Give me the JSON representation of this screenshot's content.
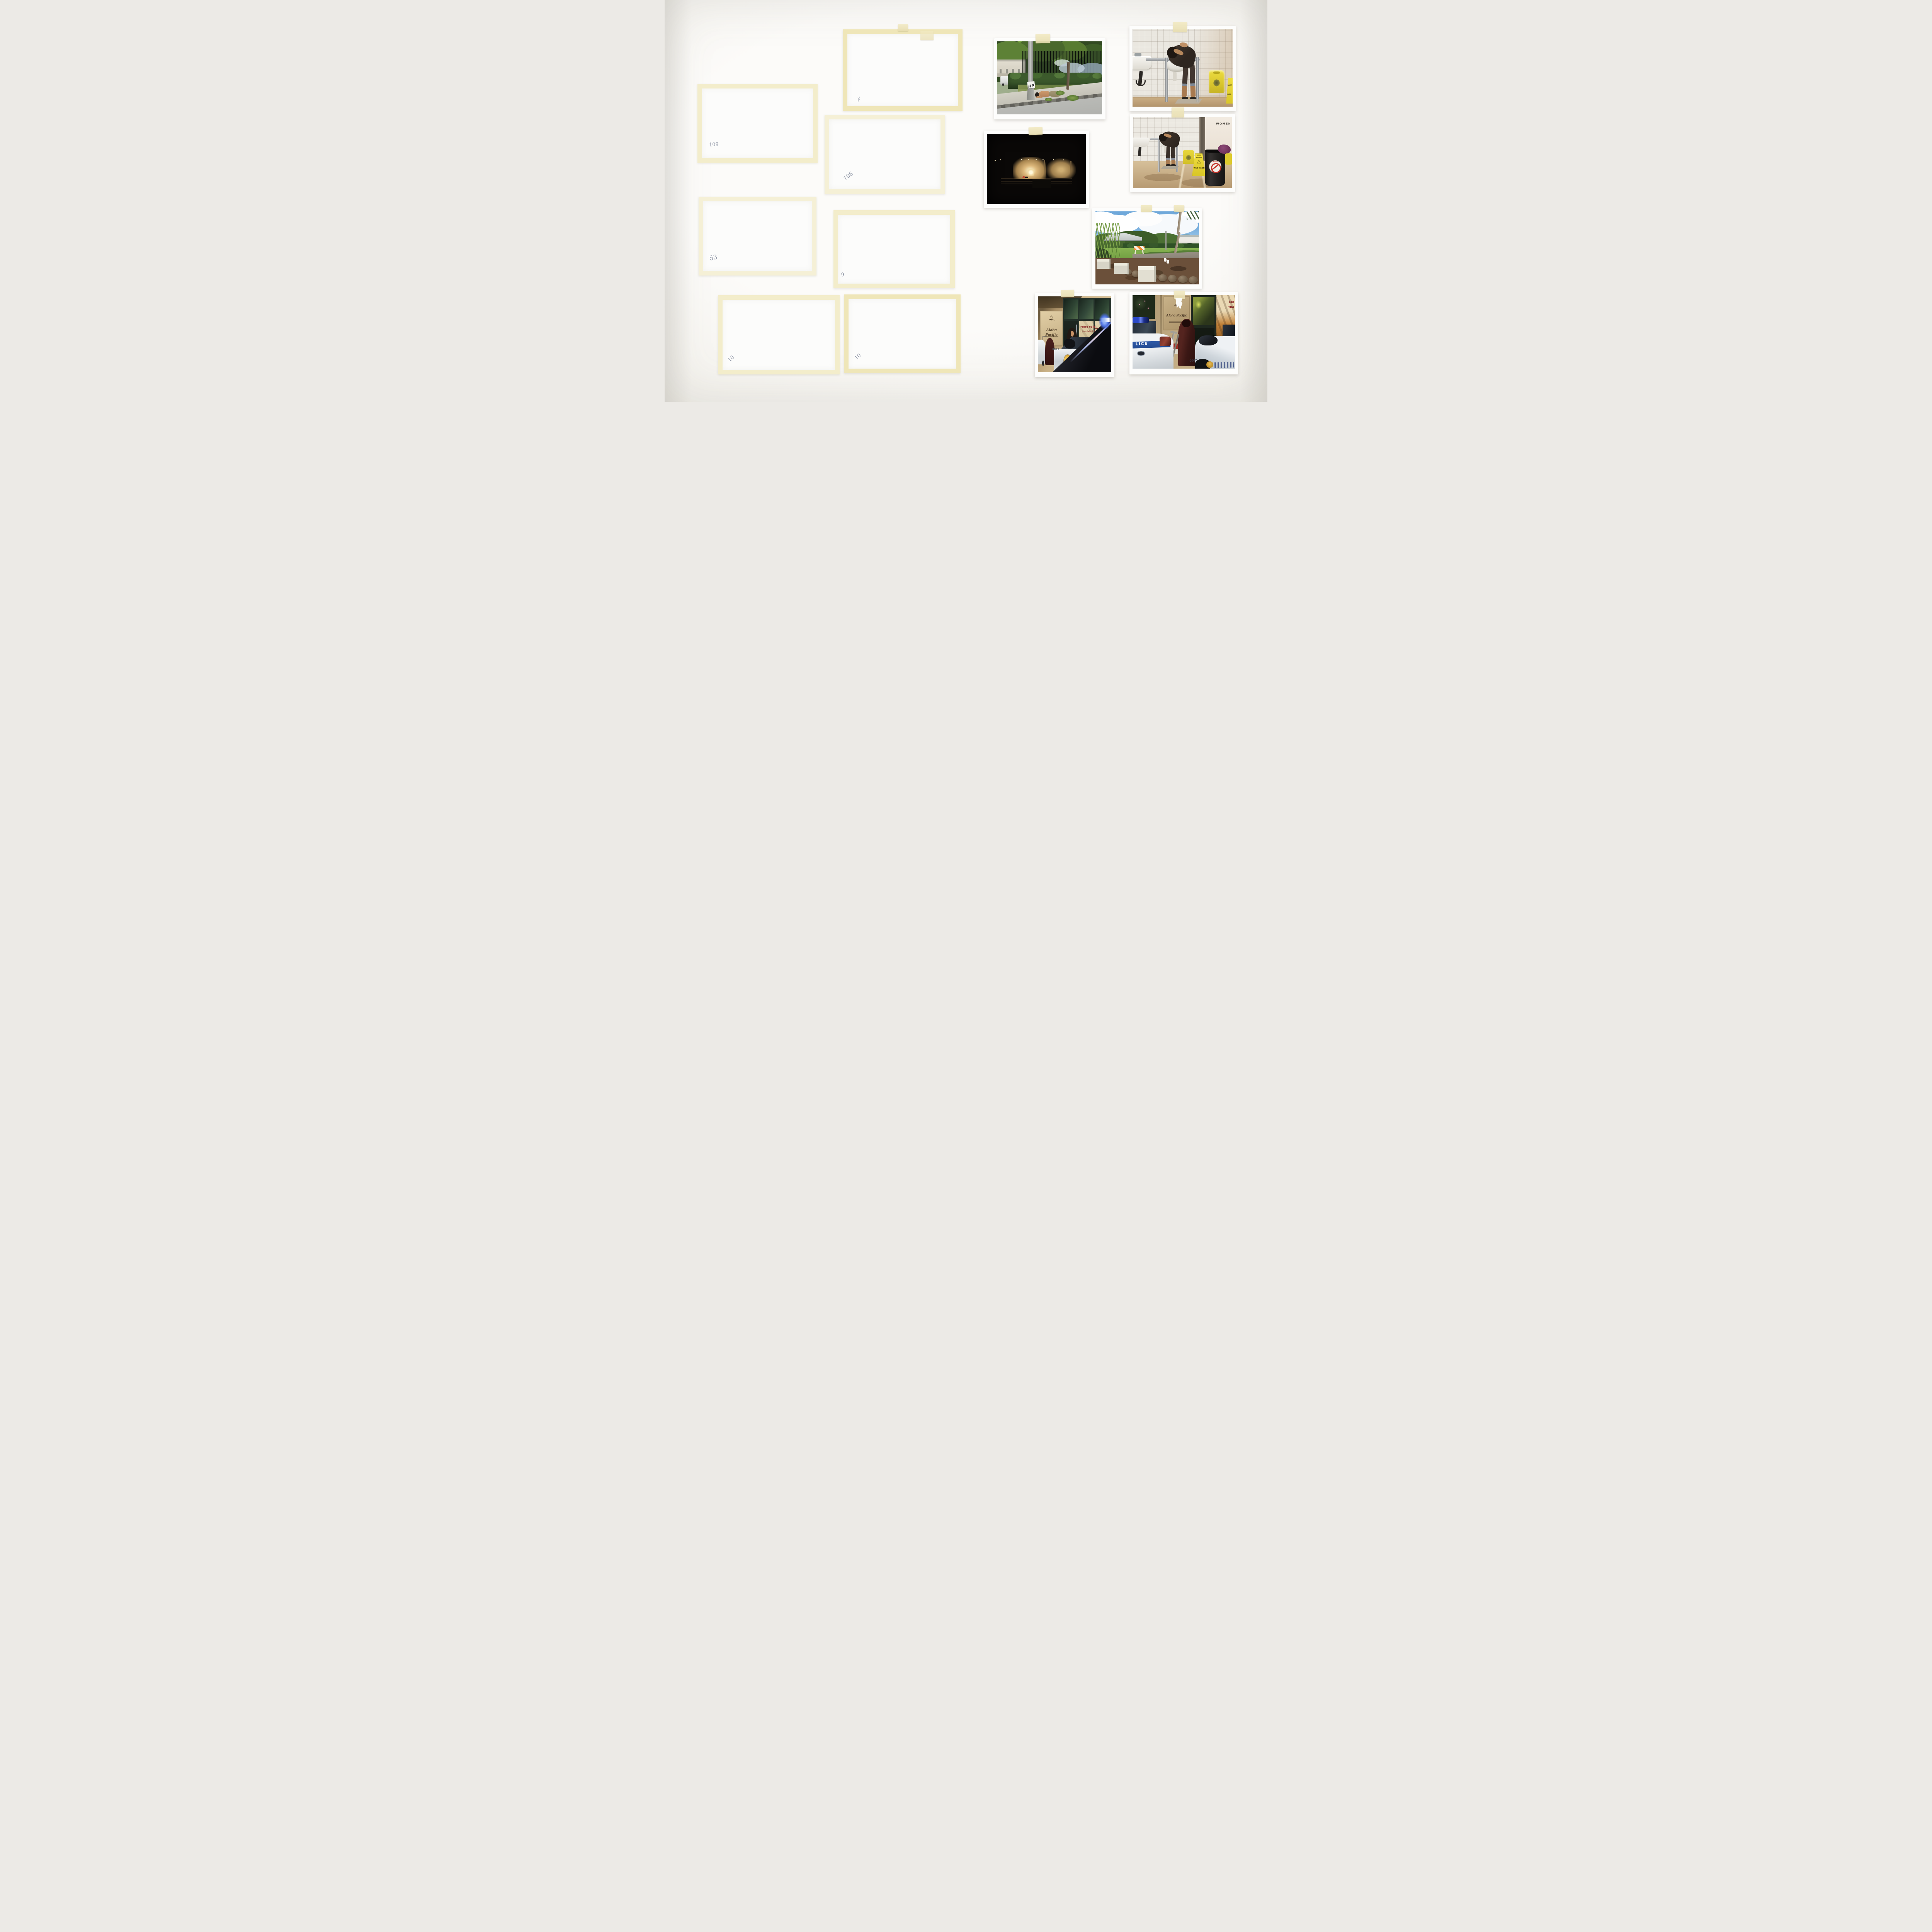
{
  "scene": {
    "description": "Photographic prints and blank file cards taped to a white studio wall",
    "wall_color": "#f7f5f2",
    "tape_color": "#f2ecca"
  },
  "cards": [
    {
      "name": "blank-card-1",
      "label": "109"
    },
    {
      "name": "blank-card-2",
      "label": "53"
    },
    {
      "name": "blank-card-3",
      "label": "10"
    },
    {
      "name": "blank-card-4",
      "label": "✗"
    },
    {
      "name": "blank-card-5",
      "label": "106"
    },
    {
      "name": "blank-card-6",
      "label": "9"
    },
    {
      "name": "blank-card-7",
      "label": "10"
    }
  ],
  "photos": {
    "street": {
      "caption": "person lying on road median beside utility pole",
      "pole_graffiti": "HP"
    },
    "restroom_close": {
      "caption": "person bent over public restroom sink",
      "caution_sign_top": "CAUT",
      "caution_sign_bottom": "WET"
    },
    "night": {
      "caption": "park pavilion lit at night"
    },
    "restroom_wide": {
      "caption": "person washing at sinks in women's restroom",
      "door_sign": "WOMEN",
      "caution_line1": "CAUTION",
      "caution_line2": "WET FLOOR",
      "trash_sticker": "Mahalo"
    },
    "park": {
      "caption": "park corner with white cubes, rocks and barricade"
    },
    "police_front": {
      "caption": "Honolulu police car outside credit union",
      "brand_sign": "Aloha Pacific",
      "window_line1": "More to be",
      "window_line2": "thankful for.",
      "window_rate": "2.49%",
      "window_fine": "WITHOUT OUR PERSONAL",
      "hood_number": "1000",
      "car_text": "HONOL",
      "badge_text": "POLICE"
    },
    "police_rear": {
      "caption": "police cars and person draped in red blanket",
      "brand_sign": "Aloha Pacific",
      "trunk_text": "LICE",
      "poster_line1": "Mo",
      "poster_line2": "tha",
      "hood_number": "1000"
    }
  }
}
